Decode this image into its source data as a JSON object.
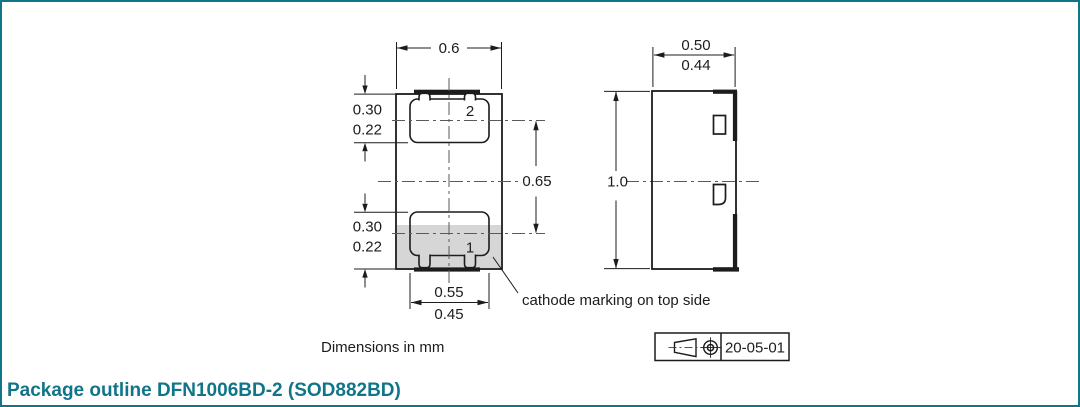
{
  "colors": {
    "accent": "#11758a",
    "cathode_shading": "#d6d6d6",
    "drawing_line": "#1c1c1c"
  },
  "footer": {
    "title": "Package outline DFN1006BD-2 (SOD882BD)"
  },
  "notes": {
    "units": "Dimensions in mm",
    "cathode": "cathode marking on top side"
  },
  "revision": {
    "date": "20-05-01",
    "symbol": "first-angle-projection"
  },
  "top_view": {
    "pad2_label": "2",
    "pad1_label": "1",
    "body_width": "0.6",
    "terminal_length_max": "0.30",
    "terminal_length_min": "0.22",
    "pitch": "0.65",
    "terminal_width_max": "0.55",
    "terminal_width_min": "0.45"
  },
  "side_view": {
    "height_max": "0.50",
    "height_min": "0.44",
    "body_length": "1.0"
  }
}
